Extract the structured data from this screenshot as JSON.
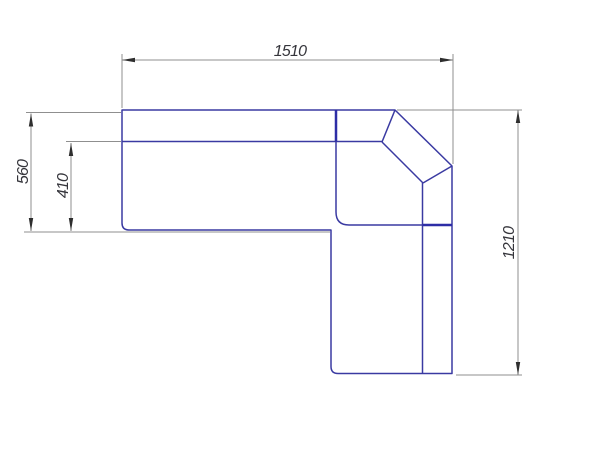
{
  "page": {
    "description": "CAD top-view dimension drawing of a corner (L-shaped) sofa",
    "background": "#ffffff"
  },
  "drawing": {
    "viewbox": "0 0 600 450",
    "colors": {
      "outline": "#3a3aa2",
      "outline_bold": "#2d2da6",
      "dim_line": "#8f8f8f",
      "arrow": "#2e2e2e",
      "label_text": "#35353b"
    },
    "sofa_outline": {
      "paths": [
        {
          "name": "sofa-outer-outline",
          "d": "M122,110 H395 L452,166 V373.5 L338,373.5 Q331,373.5 331,366.5 V230 H129 Q122,230 122,223 V110 Z",
          "stroke_width": 1.5
        },
        {
          "name": "backrest-inner-line",
          "d": "M122,141.5 H382",
          "stroke_width": 1.5
        },
        {
          "name": "corner-seat-boundary",
          "d": "M336,110 V212 Q336,225 349,225 H452",
          "stroke_width": 1.5
        },
        {
          "name": "corner-bevel-inner-left",
          "d": "M395,110 L382,142",
          "stroke_width": 1.5
        },
        {
          "name": "corner-backrest-bottom",
          "d": "M382,142 L423,183",
          "stroke_width": 1.5
        },
        {
          "name": "corner-backrest-right",
          "d": "M423,183 L452,166",
          "stroke_width": 1.5
        },
        {
          "name": "right-armrest-divider",
          "d": "M422.5,183 V373.5",
          "stroke_width": 1.5
        },
        {
          "name": "backrest-divider-bold",
          "d": "M336,110 V141.5",
          "stroke_width": 2.5
        },
        {
          "name": "armrest-cross-line-bold",
          "d": "M422.5,225 H452",
          "stroke_width": 2.5
        }
      ]
    },
    "dimensions": [
      {
        "name": "overall-width",
        "label": "1510",
        "orientation": "horizontal",
        "dim_line": {
          "x1": 122,
          "y1": 60,
          "x2": 453,
          "y2": 60
        },
        "extension_lines": [
          {
            "x1": 122,
            "y1": 54,
            "x2": 122,
            "y2": 108
          },
          {
            "x1": 453,
            "y1": 54,
            "x2": 453,
            "y2": 164
          }
        ],
        "arrows": [
          {
            "x": 122,
            "y": 60,
            "dir": "left"
          },
          {
            "x": 453,
            "y": 60,
            "dir": "right"
          }
        ],
        "text": {
          "x": 290,
          "y": 56,
          "rotate": 0
        }
      },
      {
        "name": "overall-depth",
        "label": "560",
        "orientation": "vertical",
        "dim_line": {
          "x1": 31,
          "y1": 113.5,
          "x2": 31,
          "y2": 231
        },
        "extension_lines": [
          {
            "x1": 26,
            "y1": 112.5,
            "x2": 121,
            "y2": 112.5
          }
        ],
        "arrows": [
          {
            "x": 31,
            "y": 113.5,
            "dir": "up"
          },
          {
            "x": 31,
            "y": 231,
            "dir": "down"
          }
        ],
        "text": {
          "x": 28,
          "y": 172,
          "rotate": -90
        }
      },
      {
        "name": "seat-depth",
        "label": "410",
        "orientation": "vertical",
        "dim_line": {
          "x1": 71,
          "y1": 143,
          "x2": 71,
          "y2": 231
        },
        "extension_lines": [
          {
            "x1": 66,
            "y1": 141.5,
            "x2": 121,
            "y2": 141.5
          },
          {
            "x1": 24,
            "y1": 232,
            "x2": 330,
            "y2": 232
          }
        ],
        "arrows": [
          {
            "x": 71,
            "y": 143,
            "dir": "up"
          },
          {
            "x": 71,
            "y": 231,
            "dir": "down"
          }
        ],
        "text": {
          "x": 68,
          "y": 186,
          "rotate": -90
        }
      },
      {
        "name": "right-arm-length",
        "label": "1210",
        "orientation": "vertical",
        "dim_line": {
          "x1": 518,
          "y1": 110,
          "x2": 518,
          "y2": 375
        },
        "extension_lines": [
          {
            "x1": 397,
            "y1": 110,
            "x2": 522,
            "y2": 110
          },
          {
            "x1": 456,
            "y1": 375,
            "x2": 522,
            "y2": 375
          }
        ],
        "arrows": [
          {
            "x": 518,
            "y": 110,
            "dir": "up"
          },
          {
            "x": 518,
            "y": 375,
            "dir": "down"
          }
        ],
        "text": {
          "x": 514,
          "y": 243,
          "rotate": -90
        }
      }
    ]
  }
}
